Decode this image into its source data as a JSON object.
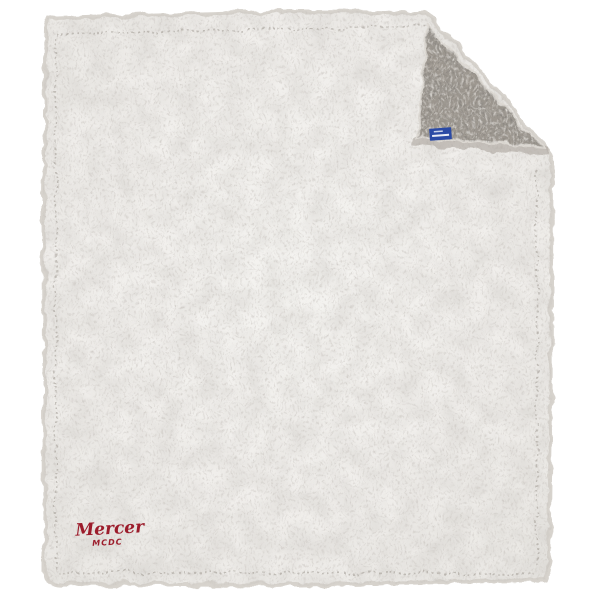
{
  "page": {
    "background_color": "#ffffff"
  },
  "product": {
    "kind": "sherpa-fleece-blanket-photo",
    "blanket": {
      "front_color": "#f1efec",
      "front_speckle_color": "#b9b4ad",
      "hem_color": "#d7d3cd",
      "seam_color": "#9a948c",
      "back_color": "#9d978f",
      "back_speckle_color": "#55504a",
      "fold_hem_shadow_color": "#a59f97",
      "fold_position": "top-right"
    },
    "tag": {
      "fill_color": "#2b4aa5",
      "text_line_color": "#ffffff"
    },
    "logo": {
      "line1": "Mercer",
      "line2": "MCDC",
      "color": "#9c1c2b"
    }
  }
}
